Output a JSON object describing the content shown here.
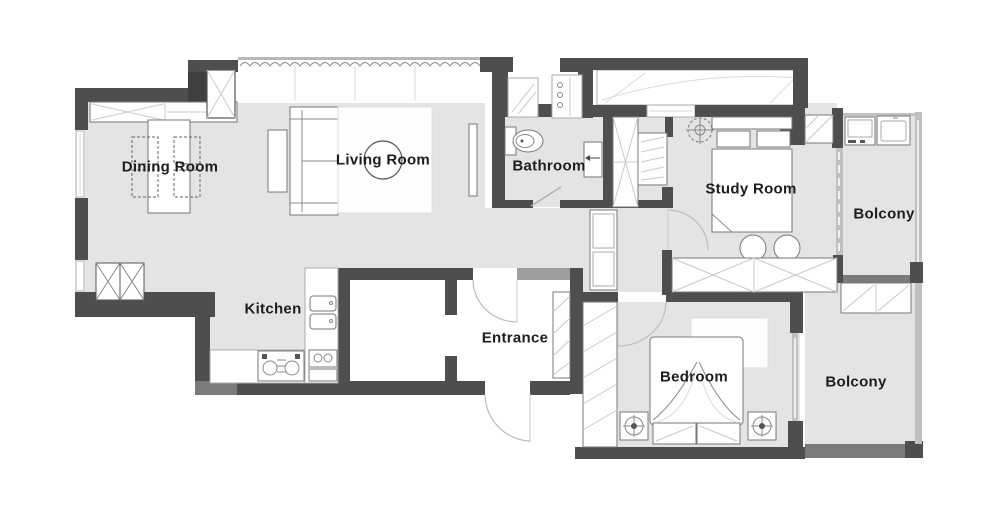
{
  "meta": {
    "type": "apartment-floor-plan"
  },
  "colors": {
    "background": "#ffffff",
    "wall_dark": "#4e4e4e",
    "wall_medium": "#7a7a7a",
    "wall_light": "#c0c0c0",
    "floor": "#e4e4e4",
    "furniture_stroke": "#777777",
    "hatch": "#c9c9c9",
    "label_text": "#1d1d1d"
  },
  "rooms": {
    "dining": {
      "label": "Dining Room"
    },
    "living": {
      "label": "Living Room"
    },
    "bathroom": {
      "label": "Bathroom"
    },
    "study": {
      "label": "Study Room"
    },
    "balcony_top": {
      "label": "Bolcony"
    },
    "kitchen": {
      "label": "Kitchen"
    },
    "entrance": {
      "label": "Entrance"
    },
    "bedroom": {
      "label": "Bedroom"
    },
    "balcony_bottom": {
      "label": "Bolcony"
    }
  },
  "symbols": [
    "dining-table",
    "dining-chair",
    "storage-cabinet",
    "structural-column",
    "sofa",
    "side-table",
    "rug",
    "round-coffee-table",
    "tv",
    "curtain-wave",
    "window",
    "door-arc",
    "toilet",
    "vanity-sink",
    "closet-shelves",
    "wardrobe",
    "ceiling-lamp",
    "single-bed",
    "armchair",
    "desk",
    "washing-machine",
    "laundry-sink",
    "fridge-cabinet",
    "stove",
    "kitchen-sink",
    "double-bed",
    "nightstand-lamp"
  ]
}
